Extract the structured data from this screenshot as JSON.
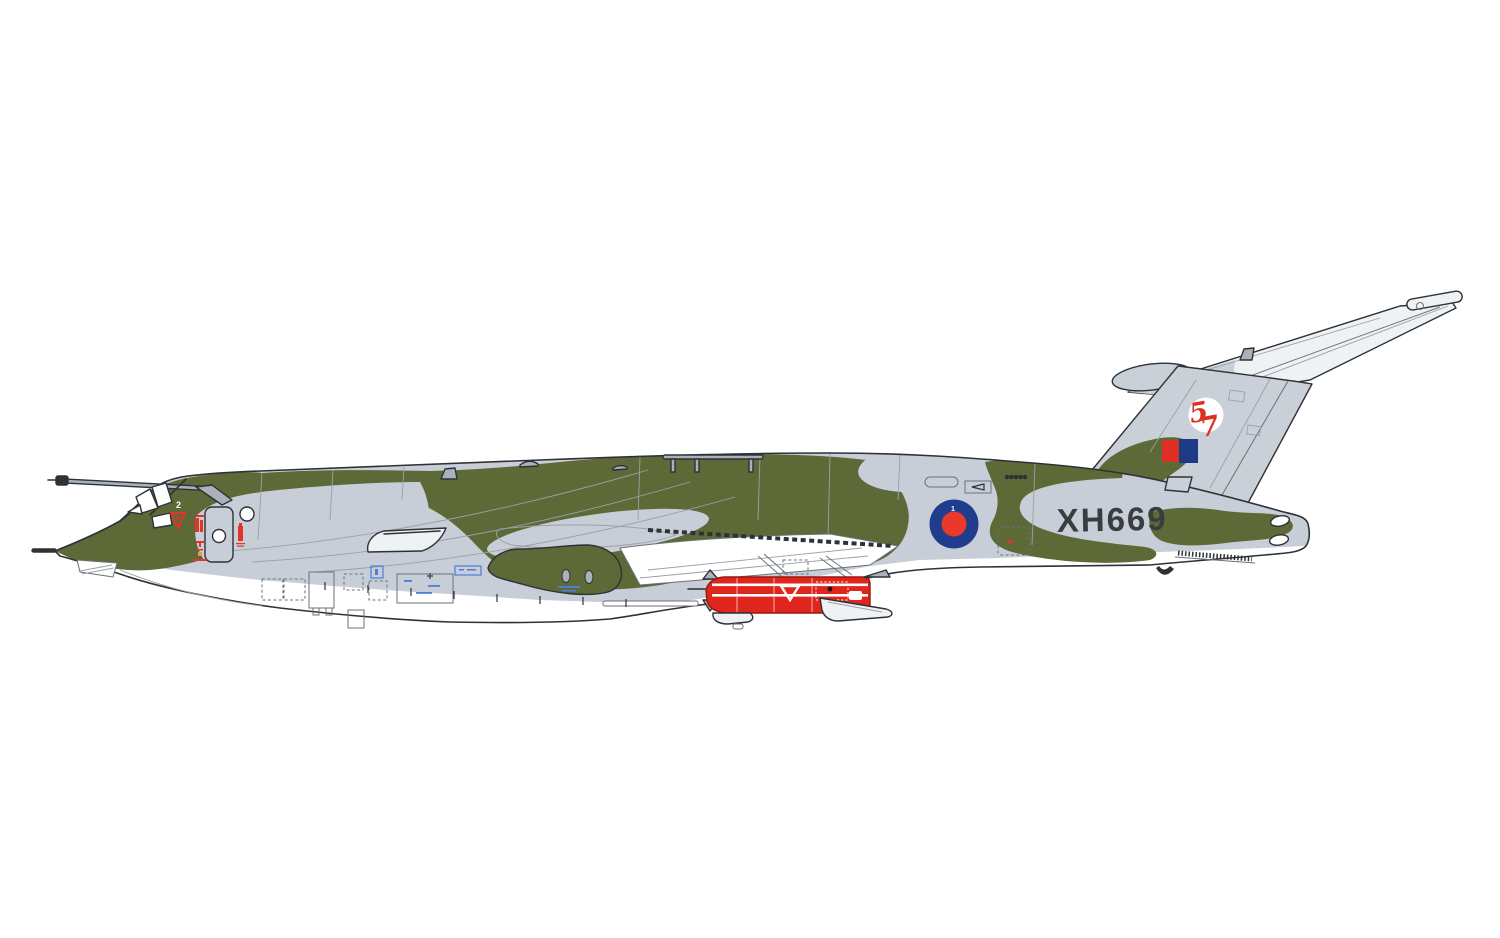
{
  "figure": {
    "kind": "aircraft-side-profile-illustration",
    "markings": {
      "serial": "XH669",
      "squadron_number": "57",
      "squadron_digit_1": "5",
      "squadron_digit_2": "7",
      "canopy_number": "2",
      "roundel_number": "1"
    },
    "colors": {
      "background": "#ffffff",
      "camo_green": "#5d6936",
      "camo_grey": "#c7ced7",
      "fin_grey": "#c9d0d8",
      "tailplane_white": "#eff2f5",
      "underside_white": "#ffffff",
      "metal_grey": "#aab1ba",
      "outline_dark": "#2e3236",
      "line_medium": "#6b7177",
      "line_light": "#9aa1a8",
      "roundel_blue": "#1f3d8c",
      "roundel_red": "#e8392b",
      "squadron_red": "#dd2f23",
      "squadron_blue": "#1d3a85",
      "missile_red": "#e0251c",
      "missile_dark_red": "#9c1712",
      "serial_grey": "#3a3d3f",
      "marking_red": "#e23427",
      "stencil_blue": "#4a7fd4",
      "stencil_amber": "#e2a23a"
    }
  }
}
